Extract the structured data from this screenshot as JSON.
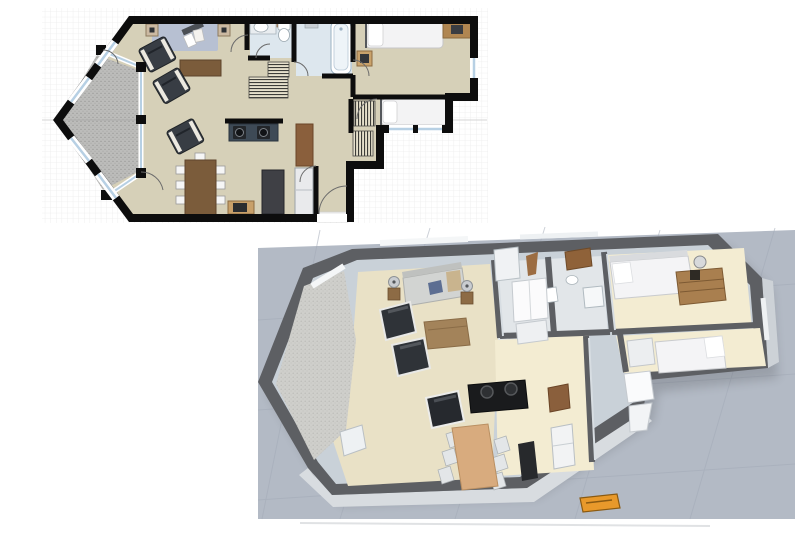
{
  "views": {
    "plan2d": {
      "name": "floorplan-2d-top-view",
      "rooms": [
        "living-room",
        "dining-area",
        "kitchen",
        "bathroom",
        "bathroom-2",
        "bedroom",
        "bedroom-2",
        "hallway",
        "entry",
        "bay-balcony"
      ],
      "furniture": [
        "area-rug",
        "armchair",
        "armchair",
        "armchair",
        "sideboard",
        "speaker",
        "speaker",
        "dining-table",
        "dining-chairs",
        "cooktop-counter",
        "kitchen-island",
        "refrigerator",
        "pantry-cabinet",
        "media-stand",
        "sink",
        "toilet",
        "bathtub",
        "bed",
        "bed",
        "desk",
        "nightstand",
        "wardrobe",
        "wardrobe",
        "wardrobe"
      ]
    },
    "plan3d": {
      "name": "floorplan-3d-dollhouse-view",
      "furniture": [
        "sofa",
        "table-lamp",
        "table-lamp",
        "armchair",
        "armchair",
        "coffee-table",
        "dining-table",
        "dining-chairs",
        "armchair",
        "cooktop-island",
        "refrigerator",
        "pantry-cabinet",
        "bed",
        "bed",
        "bed",
        "dresser",
        "fan",
        "closet-doors",
        "shower",
        "vanity",
        "bathtub",
        "toilet",
        "doormat",
        "bay-balcony"
      ]
    }
  },
  "colors": {
    "background": "#ffffff",
    "grid_line": "#ececec",
    "guide_line": "#c9c9c9",
    "wall": "#0d0d0d",
    "floor": "#d6d0b8",
    "bath_floor": "#dde7ee",
    "window_glass": "#b7d0e4",
    "window_frame": "#ffffff",
    "balcony": "#bcbcba",
    "balcony_dot": "#9a9a98",
    "rug": "#b7c0d2",
    "wood_dark": "#7b5c3b",
    "wood_mid": "#8a5f3c",
    "wood_desk": "#b08651",
    "dark_furniture": "#383d44",
    "counter": "#3e4a56",
    "island": "#3f4045",
    "fridge": "#e9eaec",
    "chair_white": "#f6f6f6",
    "bed_white": "#f3f3f4",
    "hatch_bg": "#e6e0cc",
    "hatch_line": "#3c3c38",
    "ground": "#b3bac5",
    "ground_line": "#a3abb8",
    "wall3d_top": "#5d5f63",
    "wall3d_face": "#c9d1d8",
    "wall3d_face_light": "#d8dce0",
    "floor3d_cream": "#f3ecd2",
    "floor3d_beige": "#e9e1c6",
    "floor3d_bath": "#e2e6e9",
    "sofa": "#d2d4d2",
    "pillow_blue": "#5c6e92",
    "throw_tan": "#c9b48e",
    "table3d_wood": "#d8ab7e",
    "island3d": "#1a1b1d",
    "doormat": "#e8992b",
    "doormat_line": "#8a5a12"
  }
}
